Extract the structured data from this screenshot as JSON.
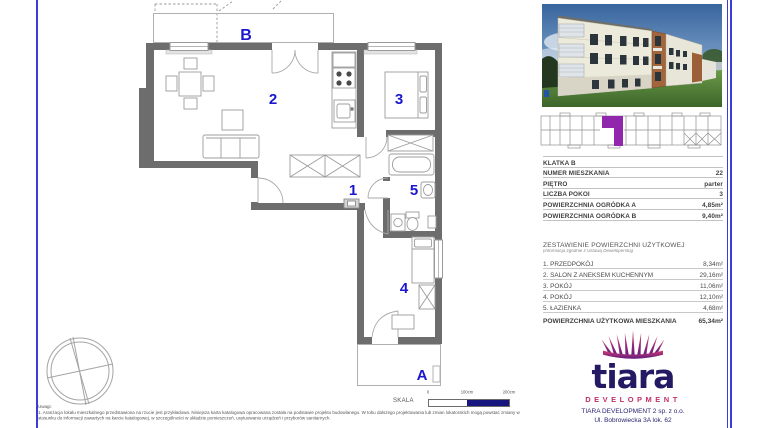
{
  "colors": {
    "accent_blue": "#1a17cf",
    "wall_gray": "#6d6d6d",
    "highlight_purple": "#9127ad",
    "logo_navy": "#231a63",
    "logo_crimson": "#c0306a",
    "border_blue": "#3b3bd8",
    "scale_fill_navy": "#16167e"
  },
  "floor_plan": {
    "labels": {
      "room1": "1",
      "room2": "2",
      "room3": "3",
      "room4": "4",
      "room5": "5",
      "garden_a": "A",
      "garden_b": "B"
    }
  },
  "unit_info": {
    "rows": [
      {
        "label": "KLATKA B",
        "value": ""
      },
      {
        "label": "NUMER MIESZKANIA",
        "value": "22"
      },
      {
        "label": "PIĘTRO",
        "value": "parter"
      },
      {
        "label": "LICZBA POKOI",
        "value": "3"
      },
      {
        "label": "POWIERZCHNIA OGRÓDKA A",
        "value": "4,85m²"
      },
      {
        "label": "POWIERZCHNIA OGRÓDKA B",
        "value": "9,40m²"
      }
    ]
  },
  "areas": {
    "title": "ZESTAWIENIE POWIERZCHNI UŻYTKOWEJ",
    "subtitle": "(informacja zgodnie z Ustawą Deweloperską)",
    "rows": [
      {
        "label": "1. PRZEDPOKÓJ",
        "value": "8,34m²"
      },
      {
        "label": "2. SALON Z ANEKSEM KUCHENNYM",
        "value": "29,16m²"
      },
      {
        "label": "3. POKÓJ",
        "value": "11,06m²"
      },
      {
        "label": "4. POKÓJ",
        "value": "12,10m²"
      },
      {
        "label": "5. ŁAZIENKA",
        "value": "4,68m²"
      }
    ],
    "total_label": "POWIERZCHNIA UŻYTKOWA MIESZKANIA",
    "total_value": "65,34m²"
  },
  "logo": {
    "brand": "tiara",
    "tagline": "DEVELOPMENT"
  },
  "company": {
    "line1": "TIARA DEVELOPMENT 2 sp. z o.o.",
    "line2": "Ul. Bobrowiecka 3A lok. 62"
  },
  "scale_bar": {
    "label": "SKALA",
    "tick0": "0",
    "tick1": "100cm",
    "tick2": "200cm"
  },
  "notes": {
    "heading": "Uwagi:",
    "item1": "1.  Aranżacja lokalu mieszkalnego przedstawiona na rzucie jest przykładowa. Niniejsza karta katalogowa opracowana została na podstawie projektu budowlanego. W toku dalszego projektowania lub zmian lokatorskich mogą powstać zmiany w stosunku do informacji zawartych na karcie katalogowej, w szczególności w układzie pomieszczeń, usytuowaniu urządzeń i przyborów sanitarnych."
  }
}
